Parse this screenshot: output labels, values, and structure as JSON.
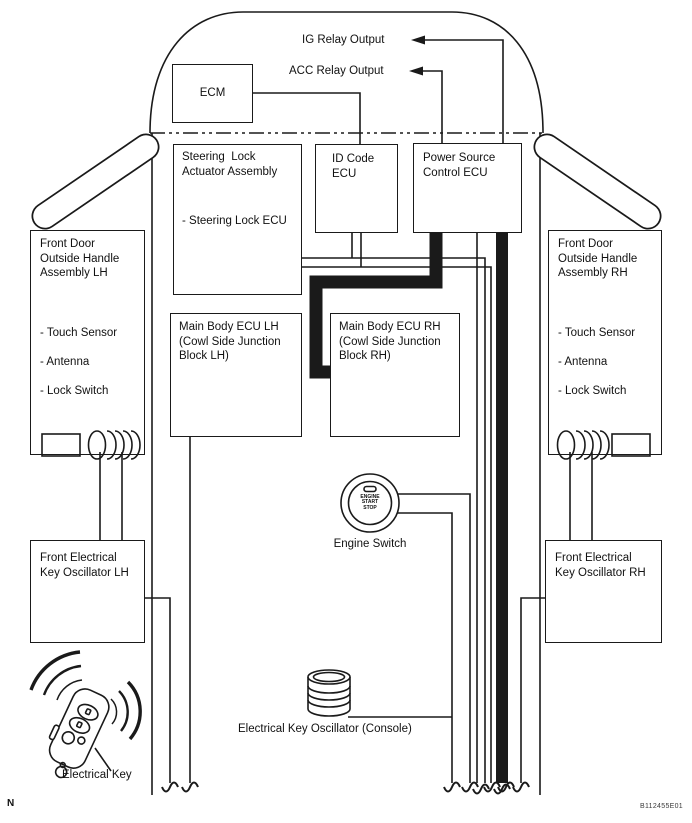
{
  "diagram": {
    "relay_outputs": {
      "ig": "IG Relay Output",
      "acc": "ACC Relay Output"
    },
    "ecm": {
      "label": "ECM"
    },
    "steering_lock": {
      "title": "Steering  Lock\nActuator Assembly",
      "item": "- Steering Lock ECU"
    },
    "id_code_ecu": {
      "title": "ID Code\nECU"
    },
    "power_source_ecu": {
      "title": "Power Source\nControl ECU"
    },
    "door_lh": {
      "title": "Front Door\nOutside Handle\nAssembly LH",
      "items": [
        "- Touch Sensor",
        "- Antenna",
        "- Lock Switch"
      ]
    },
    "door_rh": {
      "title": "Front Door\nOutside Handle\nAssembly RH",
      "items": [
        "- Touch Sensor",
        "- Antenna",
        "- Lock Switch"
      ]
    },
    "main_body_lh": {
      "title": "Main Body ECU LH\n(Cowl Side Junction\nBlock LH)"
    },
    "main_body_rh": {
      "title": "Main Body ECU RH\n(Cowl Side Junction\nBlock RH)"
    },
    "oscillator_lh": {
      "title": "Front Electrical\nKey Oscillator LH"
    },
    "oscillator_rh": {
      "title": "Front Electrical\nKey Oscillator RH"
    },
    "engine_switch": {
      "button_text": "ENGINE\nSTART\nSTOP",
      "label": "Engine Switch"
    },
    "console_oscillator": {
      "label": "Electrical Key Oscillator (Console)"
    },
    "electrical_key": {
      "label": "Electrical Key"
    },
    "footnotes": {
      "compass": "N",
      "figure_code": "B112455E01"
    },
    "colors": {
      "line": "#1a1a1a",
      "background": "#ffffff"
    }
  }
}
